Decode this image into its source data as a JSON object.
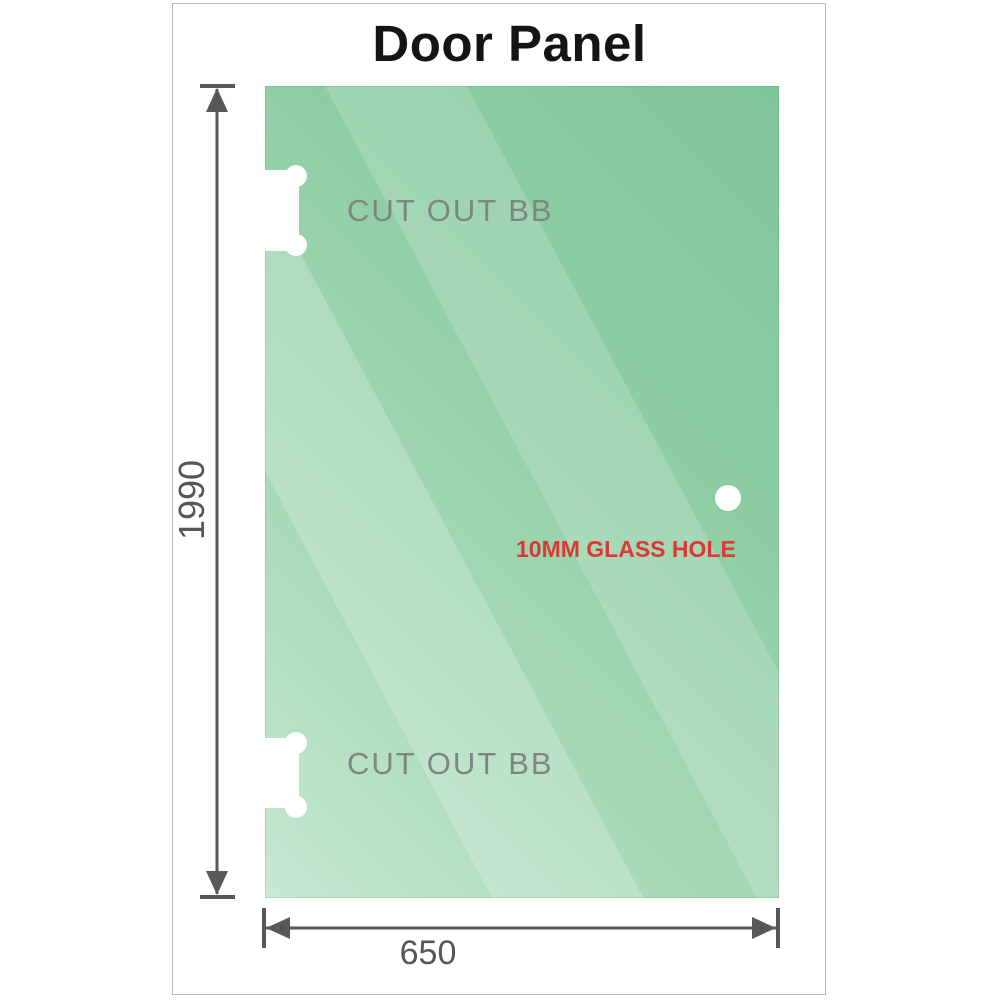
{
  "title": "Door Panel",
  "panel": {
    "cutout_top_label": "CUT OUT BB",
    "cutout_bottom_label": "CUT OUT BB",
    "hole_label": "10MM GLASS HOLE"
  },
  "dimensions": {
    "height_label": "1990",
    "width_label": "650"
  },
  "colors": {
    "glass_dark": "#7ec597",
    "glass_light": "#c8e8d2",
    "dimension_line": "#585858",
    "cutout_text": "#7d8681",
    "hole_text": "#d93a36",
    "title_text": "#141414",
    "frame_border": "#b9b9b9",
    "hole_ring": "#86caa0"
  }
}
